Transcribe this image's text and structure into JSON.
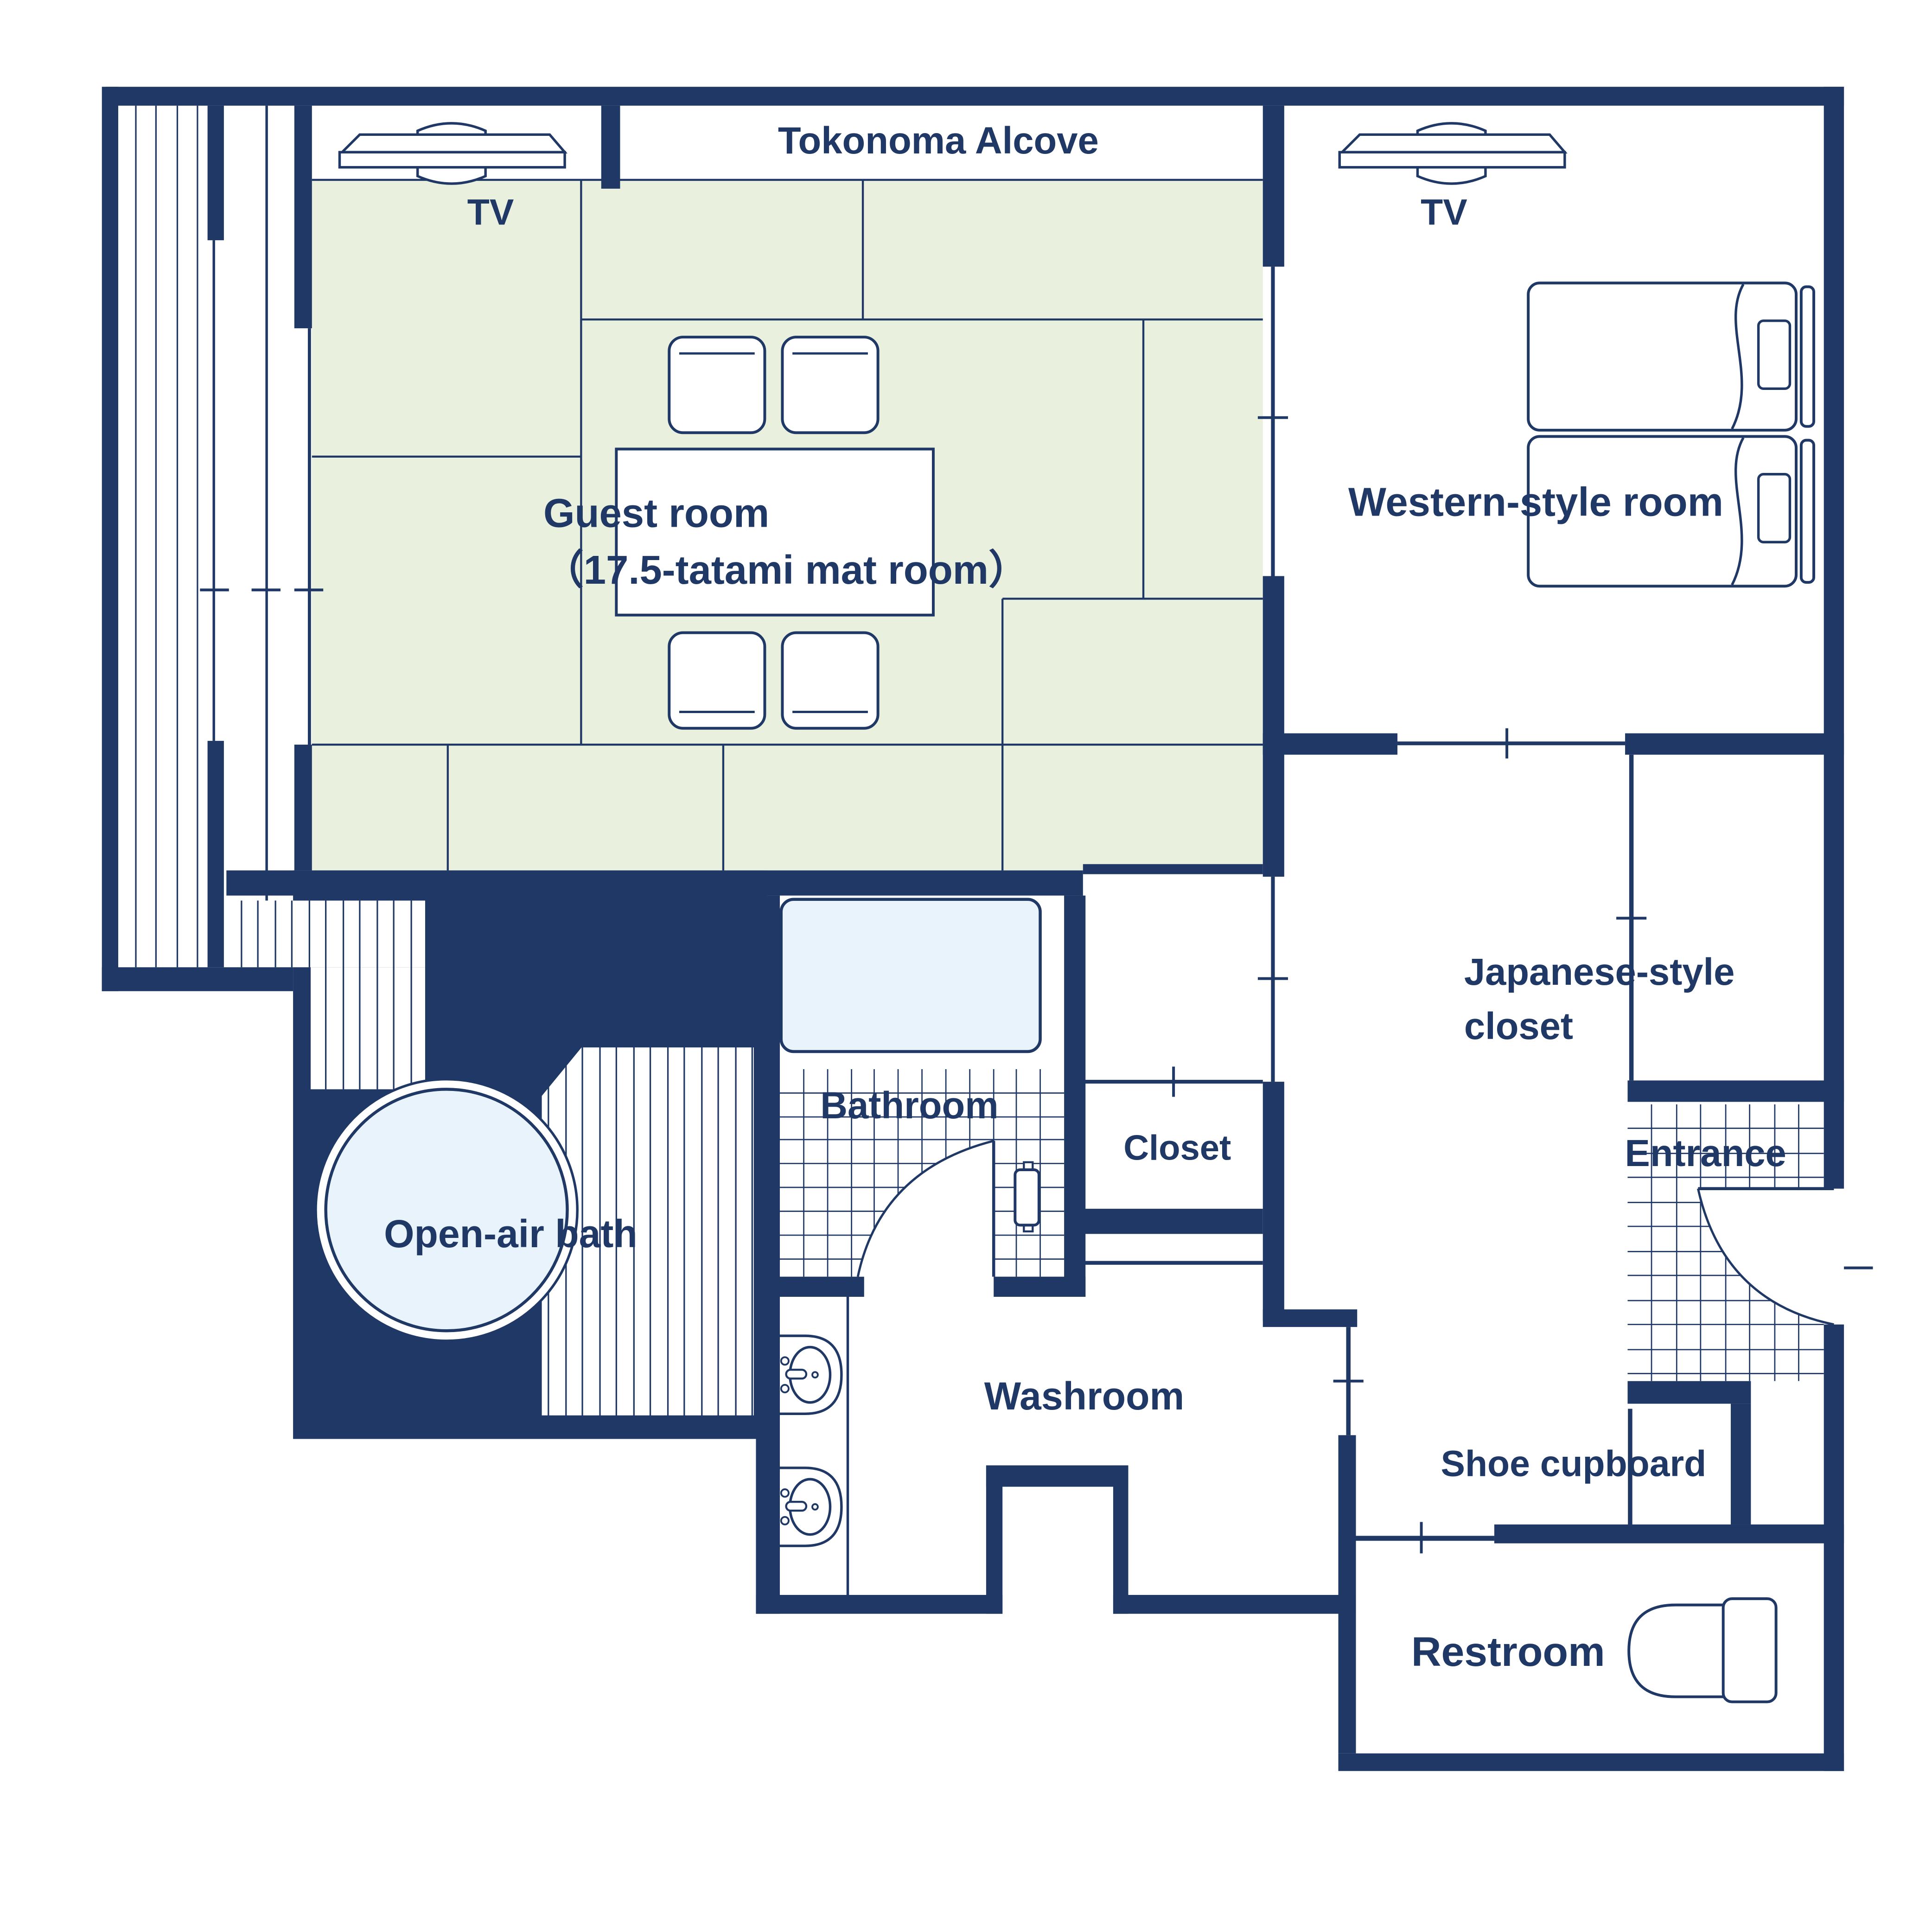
{
  "title": "Guest room floor plan",
  "palette": {
    "wall_navy": "#1f3865",
    "tatami_green": "#eaf0de",
    "water_blue": "#e8f3fb",
    "floor_white": "#ffffff",
    "line_navy": "#1f3865"
  },
  "labels": {
    "tokonoma": "Tokonoma Alcove",
    "tv_left": "TV",
    "tv_right": "TV",
    "guest_room_line1": "Guest room",
    "guest_room_line2": "（17.5-tatami mat room）",
    "western_room": "Western-style room",
    "japanese_closet_line1": "Japanese-style",
    "japanese_closet_line2": "closet",
    "closet": "Closet",
    "bathroom": "Bathroom",
    "entrance": "Entrance",
    "open_air_bath": "Open-air bath",
    "washroom": "Washroom",
    "shoe_cupboard": "Shoe cupboard",
    "restroom": "Restroom"
  },
  "icons": {
    "tv": "flat-screen TV (top view)",
    "bed": "single bed with pillow and headboard",
    "chair": "floor chair",
    "table": "low dining table",
    "bathtub": "rectangular bathtub",
    "open_air_tub": "round open-air tub",
    "sink": "washbasin with faucet",
    "toilet": "toilet with tank",
    "door_arc": "door swing arc",
    "tile_grid": "tiled floor",
    "plank_deck": "wood plank deck / veranda"
  }
}
